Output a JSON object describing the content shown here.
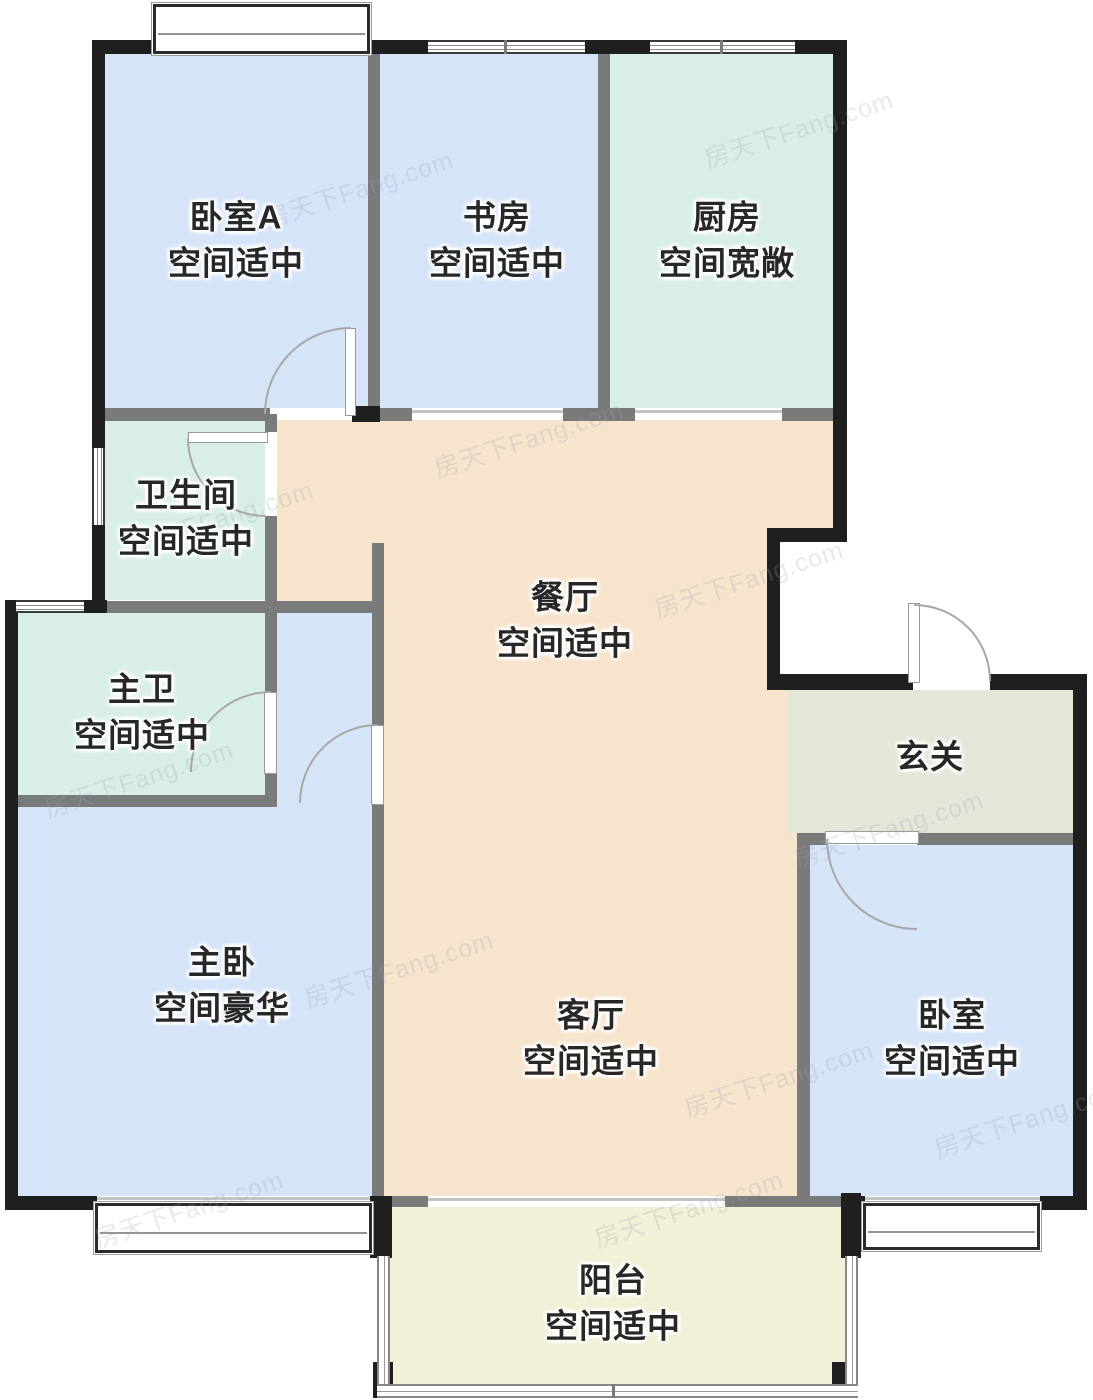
{
  "rooms": [
    {
      "name": "卧室A",
      "condition": "空间适中",
      "fill": "#d6e4f8"
    },
    {
      "name": "书房",
      "condition": "空间适中",
      "fill": "#d6e4f8"
    },
    {
      "name": "厨房",
      "condition": "空间宽敞",
      "fill": "#d9efe5"
    },
    {
      "name": "卫生间",
      "condition": "空间适中",
      "fill": "#d9efe5"
    },
    {
      "name": "餐厅",
      "condition": "空间适中",
      "fill": "#f7e4cc"
    },
    {
      "name": "主卫",
      "condition": "空间适中",
      "fill": "#d9efe5"
    },
    {
      "name": "玄关",
      "condition": "",
      "fill": "#e4e6da"
    },
    {
      "name": "主卧",
      "condition": "空间豪华",
      "fill": "#d6e4f8"
    },
    {
      "name": "客厅",
      "condition": "空间适中",
      "fill": "#f7e4cc"
    },
    {
      "name": "卧室",
      "condition": "空间适中",
      "fill": "#d6e4f8"
    },
    {
      "name": "阳台",
      "condition": "空间适中",
      "fill": "#f2f0d7"
    }
  ],
  "watermark": {
    "text": "房天下Fang.com"
  },
  "colors": {
    "bedroom_fill": "#d6e4f8",
    "kitchen_bath_fill": "#d9efe5",
    "hall_fill": "#f7e4cc",
    "entry_fill": "#e4e6da",
    "balcony_fill": "#f2f0d7",
    "wall_black": "#1f1f1f",
    "wall_gray": "#7a7a7a"
  }
}
